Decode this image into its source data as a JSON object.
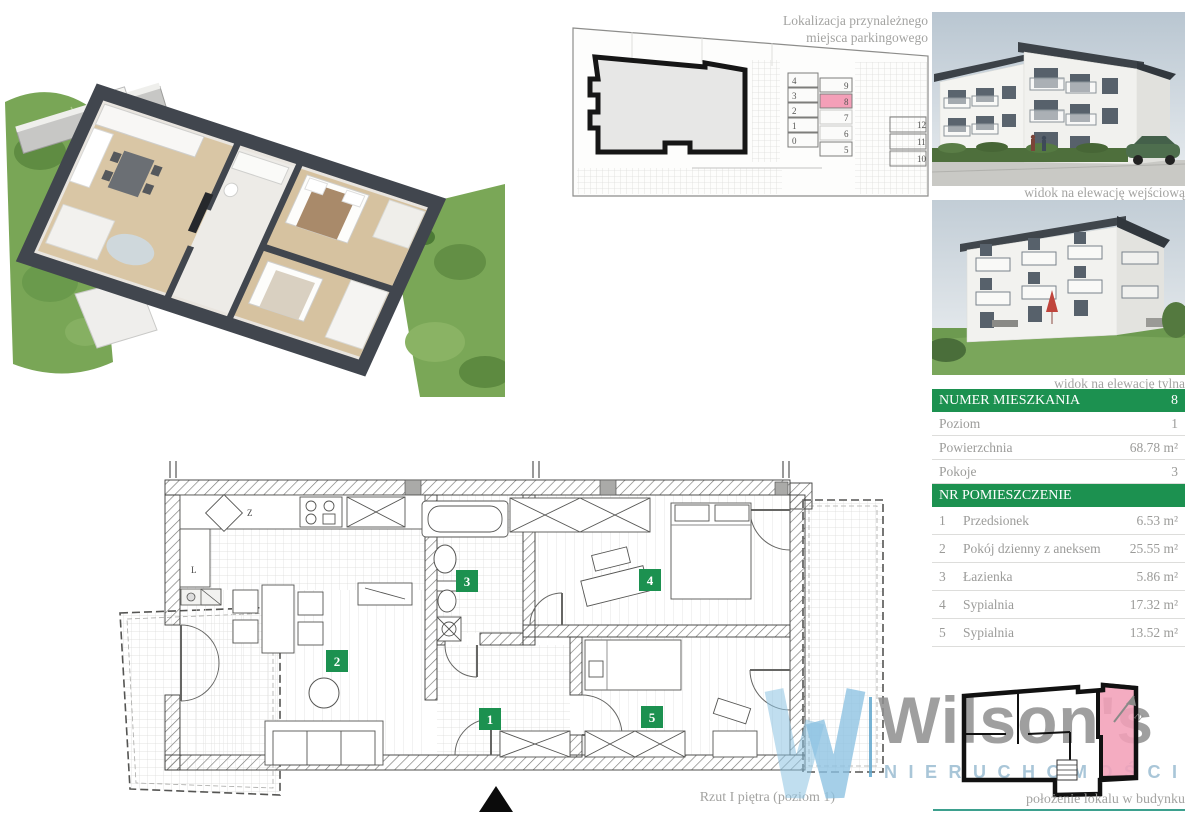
{
  "colors": {
    "green_header": "#1c9150",
    "pink_highlight": "#f49fb8",
    "gray_text": "#9b9b99",
    "caption_gray": "#a3a3a1",
    "teal_line": "#3da08e",
    "logo_gray": "#8f8f8f",
    "logo_blue": "#8cc2e2"
  },
  "parking": {
    "title_line1": "Lokalizacja przynależnego",
    "title_line2": "miejsca parkingowego",
    "left_column": [
      "4",
      "3",
      "2",
      "1",
      "0"
    ],
    "right_column": [
      "9",
      "8",
      "7",
      "6",
      "5"
    ],
    "far_column": [
      "12",
      "11",
      "10"
    ],
    "highlighted_space": "8"
  },
  "photos": {
    "entrance_caption": "widok na elewację wejściową",
    "rear_caption": "widok na elewację tylna"
  },
  "info": {
    "header_label": "NUMER MIESZKANIA",
    "header_value": "8",
    "rows": [
      {
        "label": "Poziom",
        "value": "1"
      },
      {
        "label": "Powierzchnia",
        "value": "68.78 m²"
      },
      {
        "label": "Pokoje",
        "value": "3"
      }
    ],
    "rooms_header": "NR  POMIESZCZENIE",
    "rooms": [
      {
        "nr": "1",
        "name": "Przedsionek",
        "area": "6.53 m²"
      },
      {
        "nr": "2",
        "name": "Pokój dzienny z aneksem",
        "area": "25.55 m²"
      },
      {
        "nr": "3",
        "name": "Łazienka",
        "area": "5.86 m²"
      },
      {
        "nr": "4",
        "name": "Sypialnia",
        "area": "17.32 m²"
      },
      {
        "nr": "5",
        "name": "Sypialnia",
        "area": "13.52 m²"
      }
    ]
  },
  "plan": {
    "caption": "Rzut I piętra (poziom 1)",
    "labels": [
      "1",
      "2",
      "3",
      "4",
      "5"
    ],
    "kitchen_z": "Z",
    "kitchen_l": "L"
  },
  "location": {
    "caption": "położenie lokalu w budynku",
    "north": "N"
  },
  "logo": {
    "name": "Wilson's",
    "subtitle": "NIERUCHOMOŚCI"
  }
}
